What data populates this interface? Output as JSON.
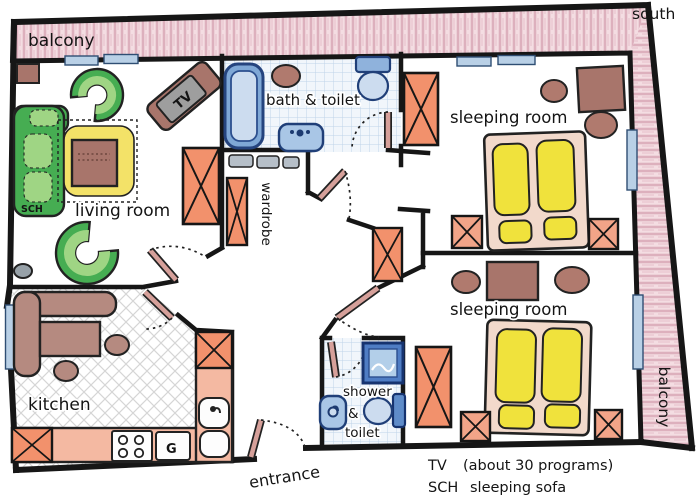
{
  "compass": {
    "south": "south"
  },
  "balcony": {
    "top_label": "balcony",
    "right_label": "balcony"
  },
  "rooms": {
    "living_room": "living room",
    "bath_toilet": "bath & toilet",
    "sleeping_room_1": "sleeping room",
    "sleeping_room_2": "sleeping room",
    "wardrobe": "wardrobe",
    "kitchen": "kitchen",
    "shower_line1": "shower",
    "shower_line2": "&",
    "shower_line3": "toilet",
    "entrance": "entrance"
  },
  "furniture": {
    "tv_label": "TV",
    "sch_label": "SCH",
    "g_label": "G"
  },
  "legend": {
    "tv_key": "TV",
    "tv_value": "(about 30 programs)",
    "sch_key": "SCH",
    "sch_value": "sleeping sofa"
  },
  "colors": {
    "wall": "#161616",
    "balcony_pink": "#f4dde2",
    "hatch_pink": "#d9a8b7",
    "window_blue": "#b9d0e6",
    "fixture_blue_light": "#ccdcef",
    "fixture_blue": "#a9c6e6",
    "fixture_navy": "#203f78",
    "tile_line": "#c0d4e8",
    "cabinet_orange": "#f2916c",
    "counter_salmon": "#f4b9a2",
    "furniture_brown": "#a8756b",
    "kitchen_brown": "#b58a80",
    "sofa_green": "#46ad52",
    "cushion_green": "#9fd584",
    "mattress_yellow": "#f0e23c",
    "seat_yellow": "#f3e268",
    "bed_frame": "#f2d9cb",
    "door_panel": "#d6a09a",
    "tv_gray": "#9e9e9e"
  }
}
